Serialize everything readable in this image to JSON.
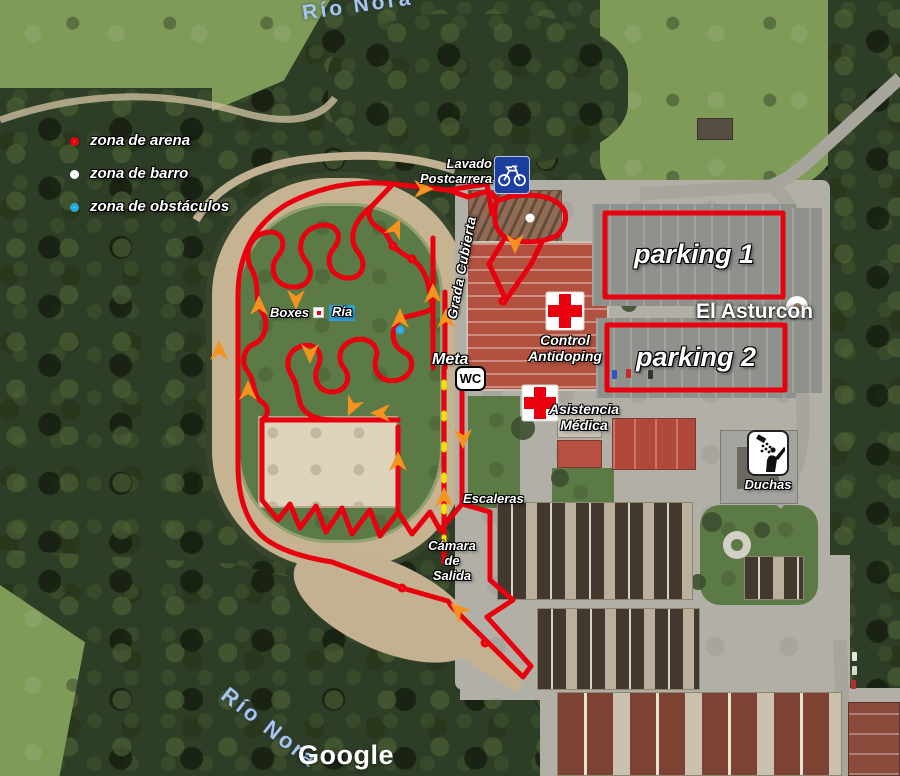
{
  "map": {
    "attribution": "Google",
    "water_labels": {
      "top": "Río Nora",
      "bottom": "Río Nora"
    },
    "poi": {
      "el_asturcon": "El Asturcon"
    }
  },
  "legend": {
    "items": [
      {
        "type": "sand",
        "label": "zona de arena"
      },
      {
        "type": "mud",
        "label": "zona de barro"
      },
      {
        "type": "obstacles",
        "label": "zona de obstáculos"
      }
    ]
  },
  "labels": {
    "lavado_line1": "Lavado",
    "lavado_line2": "Postcarrera",
    "parking1": "parking 1",
    "parking2": "parking 2",
    "grada_cubierta": "Grada Cubierta",
    "boxes": "Boxes",
    "ria": "Ría",
    "meta": "Meta",
    "wc": "WC",
    "control_line1": "Control",
    "control_line2": "Antidoping",
    "asistencia_line1": "Asistencia",
    "asistencia_line2": "Médica",
    "escaleras": "Escaleras",
    "camara_line1": "Cámara",
    "camara_line2": "de",
    "camara_line3": "Salida",
    "duchas": "Duchas"
  },
  "markers": [
    {
      "type": "sand",
      "x": 393,
      "y": 246
    },
    {
      "type": "sand",
      "x": 412,
      "y": 259
    },
    {
      "type": "sand",
      "x": 503,
      "y": 301
    },
    {
      "type": "sand",
      "x": 402,
      "y": 588
    },
    {
      "type": "sand",
      "x": 485,
      "y": 643
    },
    {
      "type": "mud",
      "x": 530,
      "y": 218
    },
    {
      "type": "obstacles",
      "x": 400,
      "y": 330
    }
  ],
  "arrows": [
    {
      "x": 219,
      "y": 350,
      "deg": 0
    },
    {
      "x": 248,
      "y": 390,
      "deg": 0
    },
    {
      "x": 259,
      "y": 305,
      "deg": 0
    },
    {
      "x": 296,
      "y": 300,
      "deg": 180
    },
    {
      "x": 310,
      "y": 354,
      "deg": 180
    },
    {
      "x": 400,
      "y": 318,
      "deg": 0
    },
    {
      "x": 380,
      "y": 413,
      "deg": 270
    },
    {
      "x": 398,
      "y": 461,
      "deg": 0
    },
    {
      "x": 424,
      "y": 189,
      "deg": 90
    },
    {
      "x": 396,
      "y": 228,
      "deg": 25
    },
    {
      "x": 515,
      "y": 244,
      "deg": 180
    },
    {
      "x": 433,
      "y": 293,
      "deg": 0
    },
    {
      "x": 446,
      "y": 318,
      "deg": 0
    },
    {
      "x": 463,
      "y": 439,
      "deg": 180
    },
    {
      "x": 444,
      "y": 497,
      "deg": 0
    },
    {
      "x": 458,
      "y": 610,
      "deg": 312
    },
    {
      "x": 352,
      "y": 407,
      "deg": 205
    }
  ],
  "colors": {
    "course": "#e8000f",
    "arrow": "#f6921e",
    "sand_center": "#ffe100",
    "mud_center": "#8d7d6b",
    "obstacle_ring": "#29abe2",
    "parking_outline": "#e8000f",
    "bike_sign_bg": "#1d3f9f",
    "water_label": "#a8c5ee"
  }
}
